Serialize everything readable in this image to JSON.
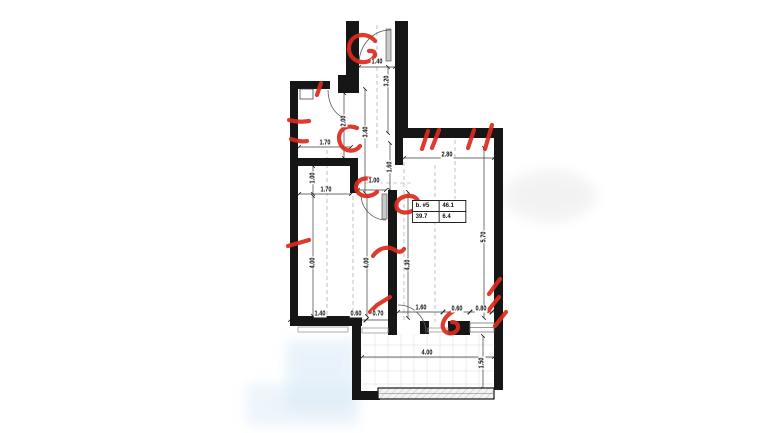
{
  "colors": {
    "wall": "#161616",
    "annotation": "#dc2a1c",
    "wash": "#dcebf7"
  },
  "area_table": {
    "r1c1": "b. #5",
    "r1c2": "46.1",
    "r2c1": "39.7",
    "r2c2": "6.4"
  },
  "dims": {
    "entry_width": "1.40",
    "entry_depth": "3.20",
    "hall_depth": "3.40",
    "bath_depth": "2.00",
    "bath_width": "1.70",
    "niche_height": "1.00",
    "niche_width": "1.70",
    "opening_width": "1.00",
    "wall_gap": "1.60",
    "room_width": "2.80",
    "room_depth": "5.70",
    "left_room_depth": "4.00",
    "mid_depth": "4.00",
    "right_room_depth": "4.30",
    "bottom_left_a": "1.40",
    "bottom_left_b": "0.60",
    "bottom_left_c": "0.70",
    "bottom_right_a": "1.60",
    "bottom_right_b": "0.60",
    "bottom_right_c": "0.80",
    "terrace_width": "4.00",
    "terrace_depth": "1.50"
  }
}
